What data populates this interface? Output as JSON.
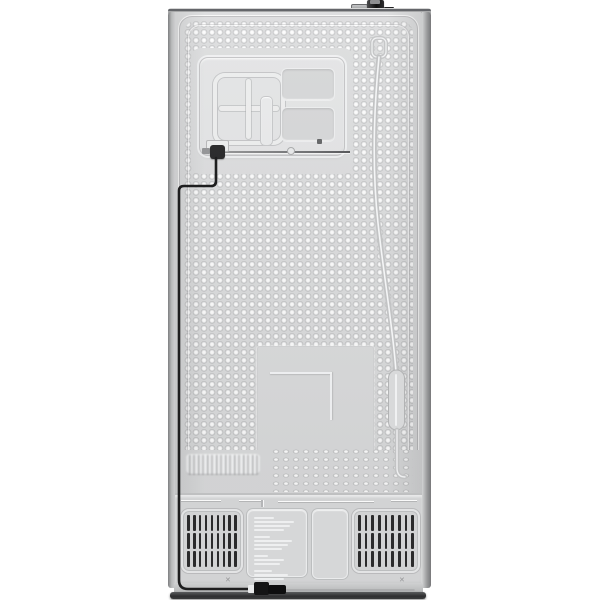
{
  "scene": {
    "subject": "refrigerator-back-view",
    "orientation": "rear",
    "background_color": "#ffffff"
  },
  "colors": {
    "background": "#ffffff",
    "panel": "#dadbdc",
    "panel_light": "#e2e3e4",
    "compartment": "#d2d3d4",
    "slat": "#2b2b2c",
    "cable": "#1d1d1e",
    "valve": "#161617",
    "tube": "#c6c7c8",
    "label_text": "#f2f3f4",
    "floor_shadow": "#2e2f30"
  },
  "parts": {
    "top": [
      "water-valve",
      "valve-nut",
      "valve-side-fitting"
    ],
    "panel": [
      "embossed-service-panel",
      "grid-emboss",
      "recessed-rect-top",
      "recessed-rect-bottom",
      "tube-fitting-line",
      "wire-connector",
      "center-smooth-rect",
      "embossed-logo",
      "coolant-tube",
      "tube-accumulator"
    ],
    "bottom": [
      "vent-grille-left",
      "rating-label",
      "mid-access-panel",
      "vent-grille-right",
      "power-cord",
      "power-plug"
    ]
  },
  "compartment": {
    "grille": {
      "rows": 3,
      "cols": 9
    },
    "label_line_groups": [
      [
        20,
        40,
        36,
        30
      ],
      [
        16,
        38,
        34,
        28
      ],
      [
        14,
        30,
        26
      ],
      [
        18,
        34,
        30
      ],
      [
        12,
        24
      ]
    ]
  },
  "texture": {
    "dimple_spacing_px": 8,
    "oval_dimple_spacing_px": 10
  }
}
